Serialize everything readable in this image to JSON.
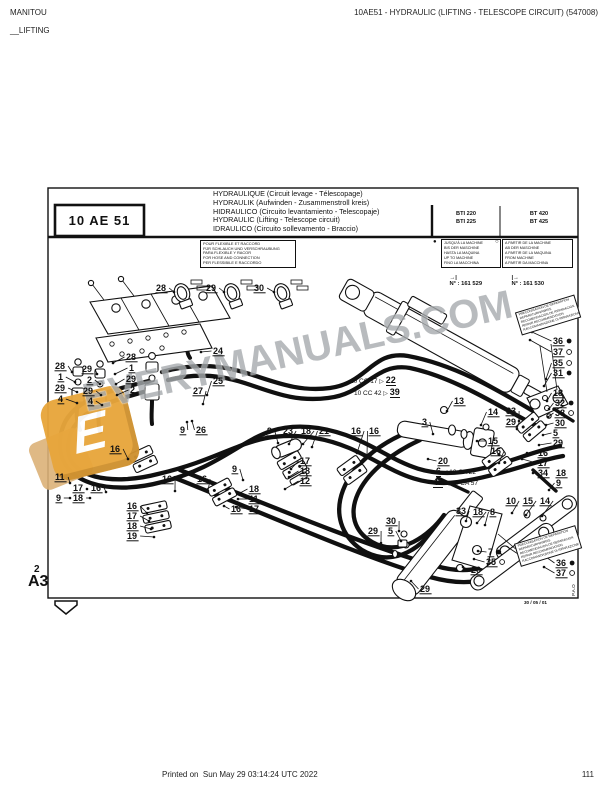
{
  "header": {
    "brand": "MANITOU",
    "section": "__LIFTING",
    "doc_title": "10AE51 - HYDRAULIC (LIFTING - TELESCOPE CIRCUIT) (547008)"
  },
  "footer": {
    "printed": "Printed on  Sun May 29 03:14:24 UTC 2022",
    "page": "111"
  },
  "title_block": {
    "code": "10 AE 51",
    "titles": [
      "HYDRAULIQUE (Circuit levage - Télescopage)",
      "HYDRAULIK (Aufwinden - Zusammenstroll kreis)",
      "HIDRAULICO (Circuito levantamiento - Telescopaje)",
      "HYDRAULIC (Lifting - Telescope circuit)",
      "IDRAULICO (Circuito sollevamento - Braccio)"
    ],
    "models_left": [
      "BTI 220",
      "BTI 225"
    ],
    "models_right": [
      "BT 420",
      "BT 425"
    ]
  },
  "hose_note": {
    "lines": [
      "POUR FLEXIBLE ET RACCORD",
      "FÜR SCHLAUCH UND VERSCHRAUBUNG",
      "PARA FLEXIBLE Y RACOR",
      "FOR HOSE AND CONNECTION",
      "PER FLESSIBILE E RACCORDO"
    ]
  },
  "serial_left": {
    "bullet": "●",
    "lines": [
      "JUSQU'À LA MACHINE",
      "BIS DER MASCHINE",
      "HASTA LA MAQUINA",
      "UP TO MACHINE",
      "FINO LA MACCHINA"
    ],
    "arrow": "→|",
    "ref": "N° : 161 529"
  },
  "serial_right": {
    "bullet": "○",
    "lines": [
      "A PARTIR DE LA MACHINE",
      "AB DER MASCHINE",
      "A PARTIR DE LA MAQUINA",
      "FROM MACHINE",
      "A PARTIR DA MACCHINA"
    ],
    "arrow": "|→",
    "ref": "N° : 161 530"
  },
  "pipe_refs": {
    "cc17": {
      "label": "10 CC 17",
      "arrow": "▷",
      "num": "22"
    },
    "cc42": {
      "label": "10 CC 42",
      "arrow": "▷",
      "num": "39"
    },
    "ca22": {
      "num": "6",
      "arrow": "◁",
      "label": "10 CA 22"
    },
    "ca57": {
      "num": "40",
      "arrow": "◁",
      "label": "10 CA 57"
    }
  },
  "signs": [
    {
      "lines": [
        "PRECONISATION DE REPARATION",
        "REPARATURHINWEIS",
        "RECOMENDACION DE REPARACION",
        "REPAIR RECOMMENDATION",
        "RACCOMANDAZIONE DI RIPARAZIONE"
      ]
    },
    {
      "lines": [
        "PRECONISATION DE REPARATION",
        "REPARATURHINWEIS",
        "RECOMENDACION DE REPARACION",
        "REPAIR RECOMMENDATION",
        "RACCOMANDAZIONE DI RIPARAZIONE"
      ]
    }
  ],
  "corner": {
    "sheet": "2",
    "format": "A3"
  },
  "plate": {
    "date": "30 / 05 / 01",
    "pao": "P.A.O"
  },
  "watermark": {
    "text": "EVERYMANUALS.COM",
    "logo_letter": "E"
  },
  "colors": {
    "hose": "#111111",
    "watermark_gray": "#a7abae",
    "logo_orange": "#e8a63c"
  },
  "callouts": [
    {
      "n": "28",
      "x": 156,
      "y": 291,
      "t": [
        174,
        292
      ]
    },
    {
      "n": "29",
      "x": 206,
      "y": 291,
      "t": [
        224,
        292
      ]
    },
    {
      "n": "30",
      "x": 254,
      "y": 291,
      "t": [
        274,
        292
      ]
    },
    {
      "n": "24",
      "x": 213,
      "y": 354,
      "t": [
        201,
        352
      ]
    },
    {
      "n": "28",
      "x": 126,
      "y": 360,
      "t": [
        113,
        363
      ]
    },
    {
      "n": "28",
      "x": 55,
      "y": 369,
      "t": [
        72,
        372
      ]
    },
    {
      "n": "1",
      "x": 58,
      "y": 380,
      "t": [
        75,
        382
      ]
    },
    {
      "n": "29",
      "x": 55,
      "y": 391,
      "t": [
        77,
        392
      ]
    },
    {
      "n": "4",
      "x": 58,
      "y": 402,
      "t": [
        77,
        403
      ]
    },
    {
      "n": "29",
      "x": 82,
      "y": 372,
      "t": [
        97,
        374
      ]
    },
    {
      "n": "2",
      "x": 87,
      "y": 383,
      "t": [
        100,
        384
      ]
    },
    {
      "n": "29",
      "x": 83,
      "y": 394,
      "t": [
        101,
        395
      ]
    },
    {
      "n": "4",
      "x": 88,
      "y": 404,
      "t": [
        102,
        405
      ]
    },
    {
      "n": "1",
      "x": 129,
      "y": 371,
      "t": [
        115,
        374
      ]
    },
    {
      "n": "29",
      "x": 126,
      "y": 382,
      "t": [
        116,
        384
      ]
    },
    {
      "n": "2",
      "x": 130,
      "y": 393,
      "t": [
        117,
        395
      ]
    },
    {
      "n": "25",
      "x": 213,
      "y": 384,
      "t": [
        207,
        395
      ]
    },
    {
      "n": "27",
      "x": 193,
      "y": 394,
      "t": [
        203,
        404
      ]
    },
    {
      "n": "9",
      "x": 180,
      "y": 433,
      "t": [
        187,
        422
      ]
    },
    {
      "n": "26",
      "x": 196,
      "y": 433,
      "t": [
        192,
        421
      ]
    },
    {
      "n": "13",
      "x": 454,
      "y": 404,
      "t": [
        447,
        411
      ]
    },
    {
      "n": "9",
      "x": 267,
      "y": 434,
      "t": [
        278,
        443
      ]
    },
    {
      "n": "23",
      "x": 283,
      "y": 434,
      "t": [
        289,
        444
      ]
    },
    {
      "n": "18",
      "x": 301,
      "y": 434,
      "t": [
        303,
        444
      ]
    },
    {
      "n": "21",
      "x": 319,
      "y": 434,
      "t": [
        312,
        447
      ]
    },
    {
      "n": "16",
      "x": 351,
      "y": 434,
      "t": [
        357,
        453
      ]
    },
    {
      "n": "16",
      "x": 369,
      "y": 434,
      "t": [
        367,
        456
      ]
    },
    {
      "n": "36",
      "x": 553,
      "y": 344,
      "d": "f",
      "t": [
        532,
        332
      ]
    },
    {
      "n": "37",
      "x": 553,
      "y": 355,
      "d": "o",
      "t": [
        530,
        340
      ]
    },
    {
      "n": "35",
      "x": 553,
      "y": 366,
      "d": "o",
      "t": [
        546,
        379
      ]
    },
    {
      "n": "31",
      "x": 553,
      "y": 376,
      "d": "f",
      "t": [
        544,
        386
      ]
    },
    {
      "n": "14",
      "x": 488,
      "y": 415,
      "t": [
        481,
        425
      ]
    },
    {
      "n": "3",
      "x": 422,
      "y": 425,
      "t": [
        433,
        434
      ]
    },
    {
      "n": "15",
      "x": 488,
      "y": 444,
      "t": [
        477,
        441
      ]
    },
    {
      "n": "33",
      "x": 506,
      "y": 414,
      "t": [
        519,
        421
      ]
    },
    {
      "n": "29",
      "x": 506,
      "y": 425,
      "t": [
        517,
        429
      ]
    },
    {
      "n": "18",
      "x": 553,
      "y": 396,
      "t": [
        547,
        401
      ]
    },
    {
      "n": "32",
      "x": 555,
      "y": 406,
      "d": "f",
      "t": [
        549,
        409
      ]
    },
    {
      "n": "38",
      "x": 555,
      "y": 416,
      "d": "o",
      "t": [
        548,
        417
      ]
    },
    {
      "n": "30",
      "x": 555,
      "y": 426,
      "t": [
        546,
        425
      ]
    },
    {
      "n": "5",
      "x": 553,
      "y": 436,
      "t": [
        543,
        435
      ]
    },
    {
      "n": "29",
      "x": 553,
      "y": 446,
      "t": [
        539,
        445
      ]
    },
    {
      "n": "16",
      "x": 538,
      "y": 456,
      "t": [
        527,
        453
      ]
    },
    {
      "n": "17",
      "x": 538,
      "y": 466,
      "t": [
        522,
        459
      ]
    },
    {
      "n": "34",
      "x": 538,
      "y": 476,
      "t": [
        533,
        473
      ]
    },
    {
      "n": "18",
      "x": 556,
      "y": 476
    },
    {
      "n": "9",
      "x": 556,
      "y": 486,
      "t": [
        549,
        490
      ]
    },
    {
      "n": "20",
      "x": 438,
      "y": 464,
      "t": [
        428,
        459
      ]
    },
    {
      "n": "16",
      "x": 491,
      "y": 454,
      "t": [
        499,
        463
      ]
    },
    {
      "n": "16",
      "x": 110,
      "y": 452,
      "t": [
        128,
        459
      ]
    },
    {
      "n": "9",
      "x": 232,
      "y": 472,
      "t": [
        243,
        480
      ]
    },
    {
      "n": "17",
      "x": 300,
      "y": 464,
      "t": [
        291,
        469
      ]
    },
    {
      "n": "18",
      "x": 300,
      "y": 474,
      "t": [
        289,
        477
      ]
    },
    {
      "n": "12",
      "x": 300,
      "y": 484,
      "t": [
        285,
        489
      ]
    },
    {
      "n": "11",
      "x": 55,
      "y": 480,
      "t": [
        70,
        483
      ]
    },
    {
      "n": "17",
      "x": 73,
      "y": 491,
      "t": [
        87,
        489
      ]
    },
    {
      "n": "16",
      "x": 91,
      "y": 491,
      "t": [
        106,
        492
      ]
    },
    {
      "n": "9",
      "x": 56,
      "y": 501,
      "t": [
        70,
        498
      ]
    },
    {
      "n": "18",
      "x": 73,
      "y": 501,
      "t": [
        90,
        498
      ]
    },
    {
      "n": "16",
      "x": 162,
      "y": 482,
      "t": [
        175,
        491
      ]
    },
    {
      "n": "16",
      "x": 197,
      "y": 482,
      "t": [
        208,
        491
      ]
    },
    {
      "n": "18",
      "x": 249,
      "y": 492,
      "t": [
        240,
        493
      ]
    },
    {
      "n": "11",
      "x": 249,
      "y": 502,
      "t": [
        238,
        499
      ]
    },
    {
      "n": "16",
      "x": 231,
      "y": 512,
      "t": [
        224,
        506
      ]
    },
    {
      "n": "17",
      "x": 249,
      "y": 512,
      "t": [
        236,
        507
      ]
    },
    {
      "n": "16",
      "x": 127,
      "y": 509,
      "t": [
        147,
        513
      ]
    },
    {
      "n": "17",
      "x": 127,
      "y": 519,
      "t": [
        149,
        521
      ]
    },
    {
      "n": "18",
      "x": 127,
      "y": 529,
      "t": [
        151,
        529
      ]
    },
    {
      "n": "19",
      "x": 127,
      "y": 539,
      "t": [
        154,
        537
      ]
    },
    {
      "n": "10",
      "x": 506,
      "y": 504,
      "t": [
        512,
        513
      ]
    },
    {
      "n": "15",
      "x": 523,
      "y": 504,
      "t": [
        526,
        515
      ]
    },
    {
      "n": "14",
      "x": 540,
      "y": 504,
      "t": [
        542,
        516
      ]
    },
    {
      "n": "33",
      "x": 456,
      "y": 514,
      "t": [
        466,
        521
      ]
    },
    {
      "n": "18",
      "x": 473,
      "y": 515,
      "t": [
        477,
        523
      ]
    },
    {
      "n": "8",
      "x": 490,
      "y": 515,
      "t": [
        485,
        525
      ]
    },
    {
      "n": "30",
      "x": 386,
      "y": 524,
      "t": [
        399,
        531
      ]
    },
    {
      "n": "5",
      "x": 388,
      "y": 534,
      "t": [
        401,
        541
      ]
    },
    {
      "n": "29",
      "x": 368,
      "y": 534,
      "t": [
        381,
        543
      ]
    },
    {
      "n": "7",
      "x": 488,
      "y": 555,
      "d": "f",
      "t": [
        478,
        551
      ]
    },
    {
      "n": "35",
      "x": 486,
      "y": 565,
      "d": "o",
      "t": [
        474,
        559
      ]
    },
    {
      "n": "20",
      "x": 471,
      "y": 573,
      "t": [
        463,
        567
      ]
    },
    {
      "n": "36",
      "x": 556,
      "y": 566,
      "d": "f",
      "t": [
        546,
        557
      ]
    },
    {
      "n": "37",
      "x": 556,
      "y": 576,
      "d": "o",
      "t": [
        544,
        567
      ]
    },
    {
      "n": "29",
      "x": 420,
      "y": 592,
      "t": [
        411,
        581
      ]
    }
  ]
}
